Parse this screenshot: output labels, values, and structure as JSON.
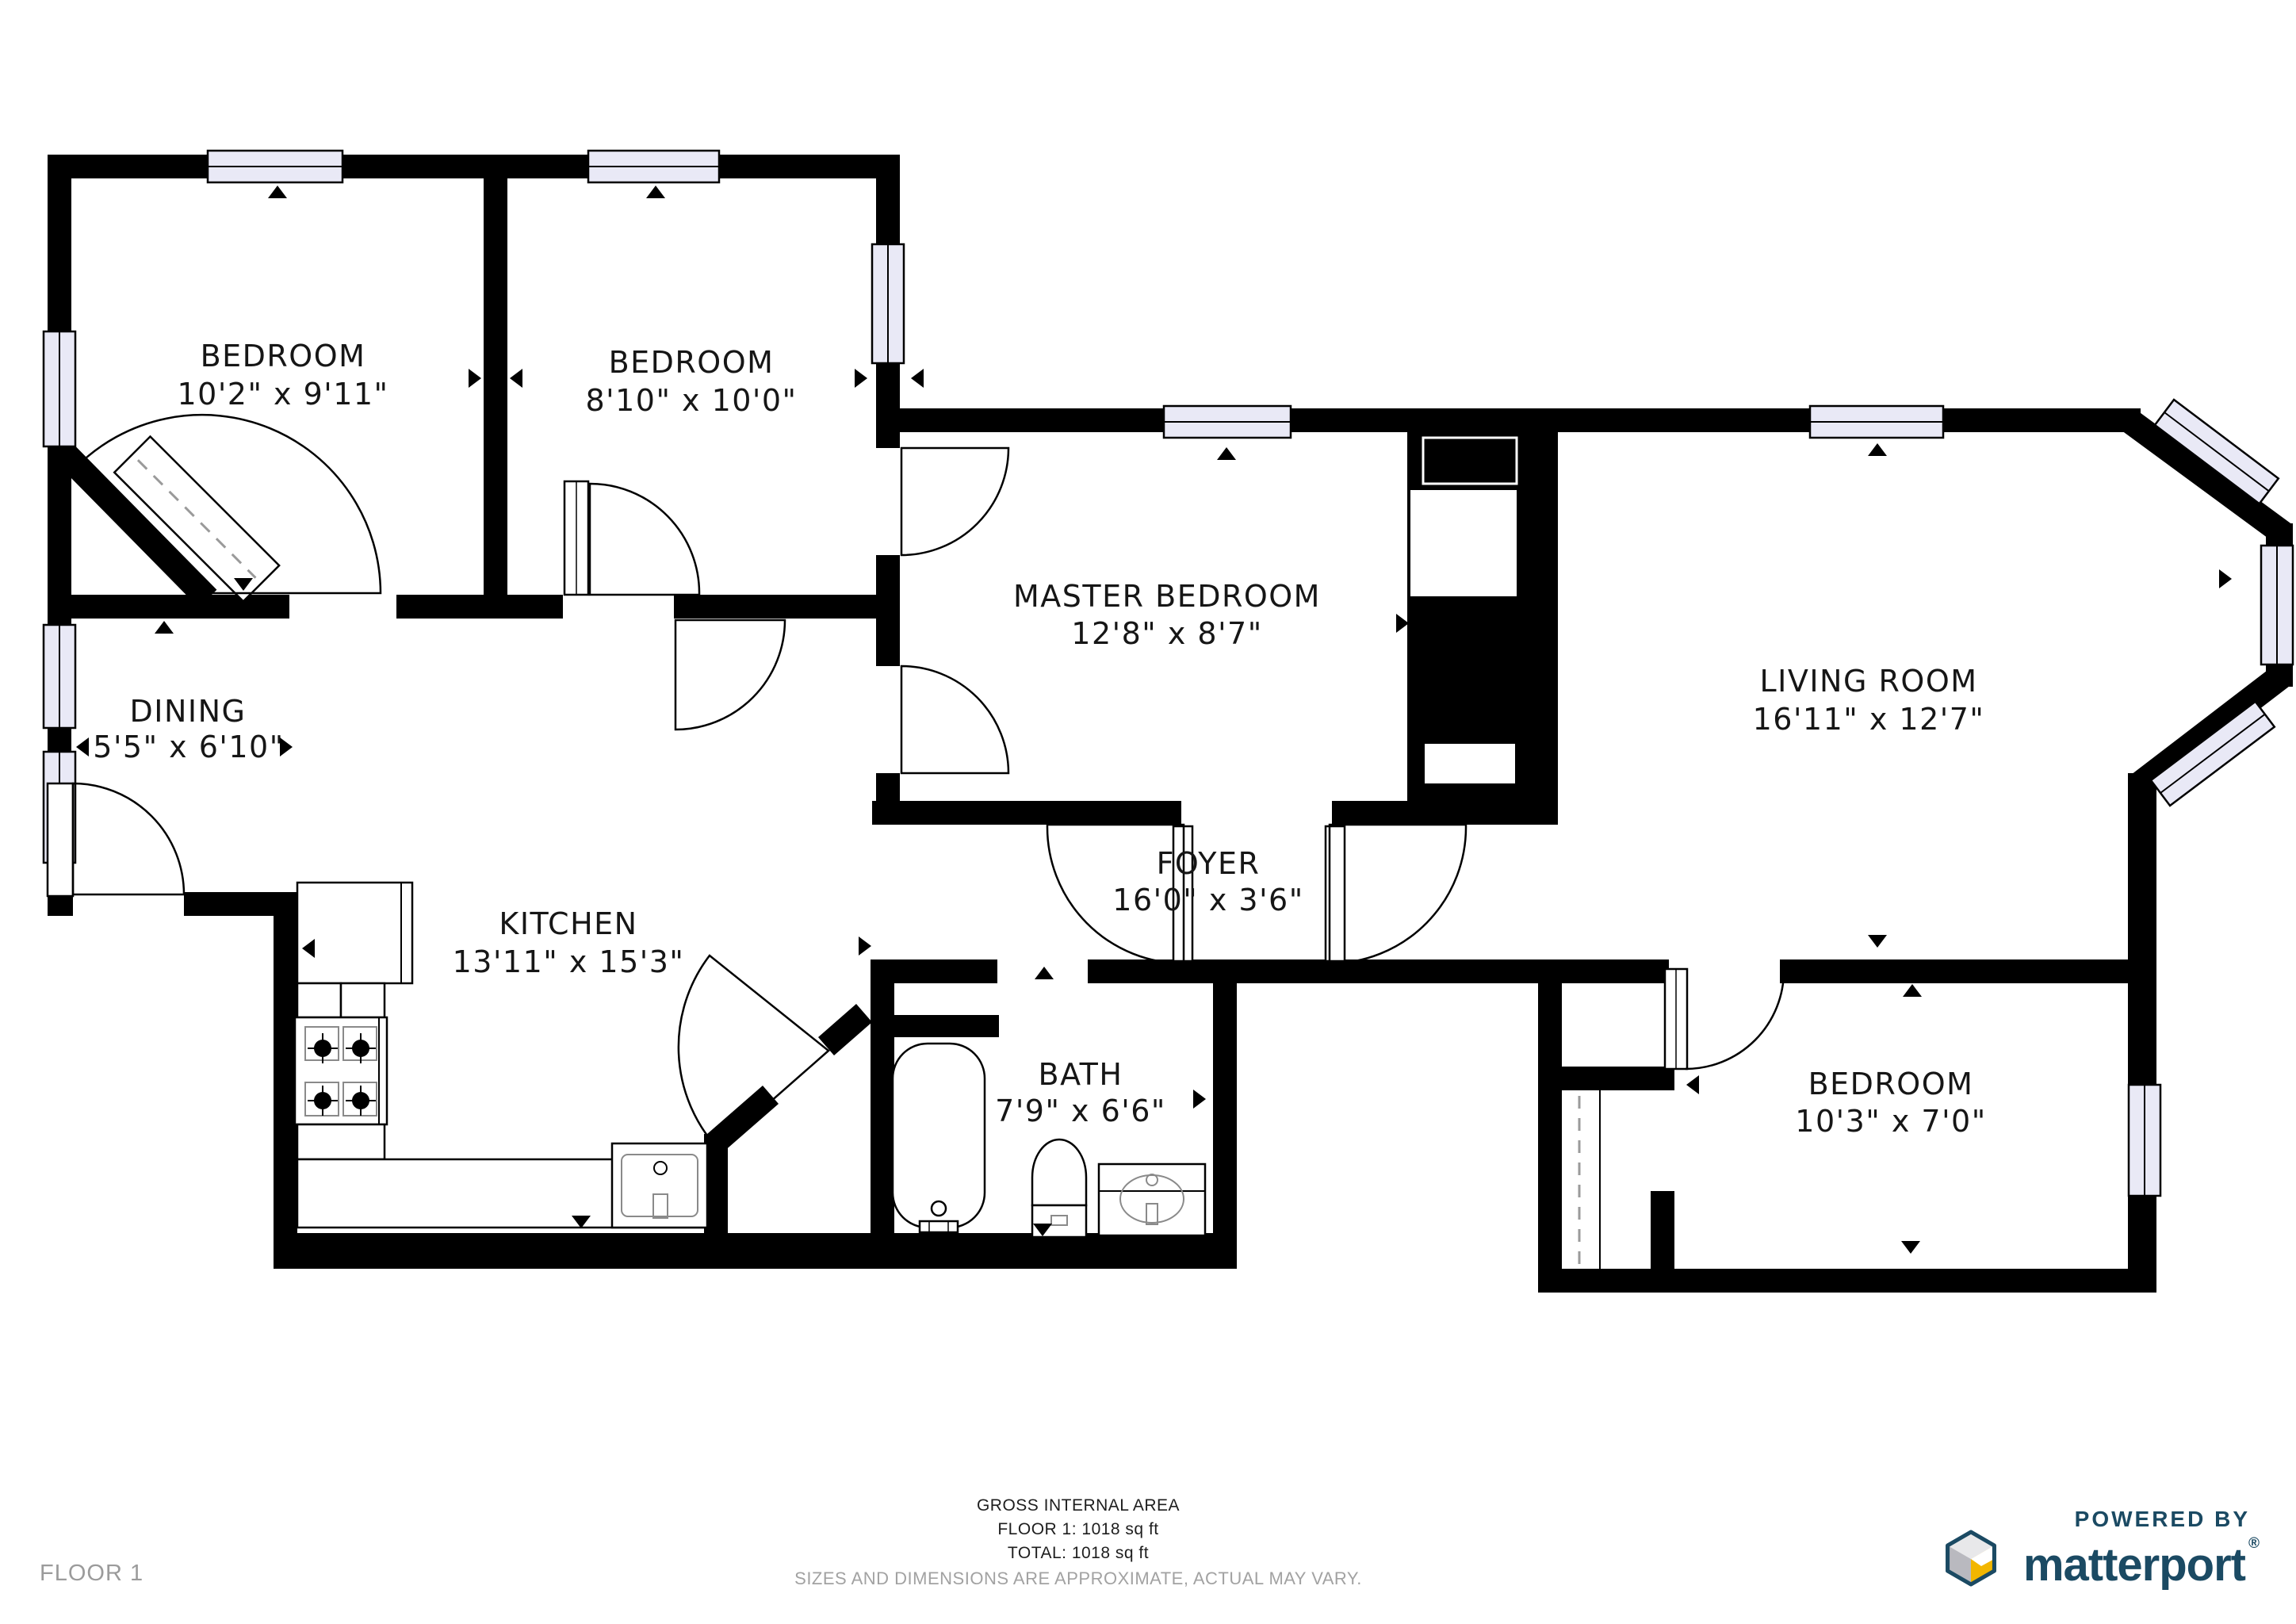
{
  "plan": {
    "rooms": [
      {
        "id": "bedroom-1",
        "name": "BEDROOM",
        "dims": "10'2\" x 9'11\""
      },
      {
        "id": "bedroom-2",
        "name": "BEDROOM",
        "dims": "8'10\" x 10'0\""
      },
      {
        "id": "master-bedroom",
        "name": "MASTER BEDROOM",
        "dims": "12'8\" x 8'7\""
      },
      {
        "id": "living-room",
        "name": "LIVING ROOM",
        "dims": "16'11\" x 12'7\""
      },
      {
        "id": "dining",
        "name": "DINING",
        "dims": "5'5\" x 6'10\""
      },
      {
        "id": "kitchen",
        "name": "KITCHEN",
        "dims": "13'11\" x 15'3\""
      },
      {
        "id": "foyer",
        "name": "FOYER",
        "dims": "16'0\" x 3'6\""
      },
      {
        "id": "bath",
        "name": "BATH",
        "dims": "7'9\" x 6'6\""
      },
      {
        "id": "bedroom-3",
        "name": "BEDROOM",
        "dims": "10'3\" x 7'0\""
      }
    ]
  },
  "footer": {
    "gross_internal_area": "GROSS INTERNAL AREA",
    "floor_area": "FLOOR 1: 1018 sq ft",
    "total_area": "TOTAL: 1018 sq ft",
    "disclaimer": "SIZES AND DIMENSIONS ARE APPROXIMATE, ACTUAL MAY VARY."
  },
  "floor_label": "FLOOR 1",
  "branding": {
    "powered_by": "POWERED BY",
    "brand": "matterport",
    "registered": "®"
  },
  "colors": {
    "wall": "#000000",
    "window_fill": "#e9e9f6",
    "brand_navy": "#1b4a63",
    "brand_yellow": "#f2b600",
    "muted_text": "#9b9b9b"
  }
}
